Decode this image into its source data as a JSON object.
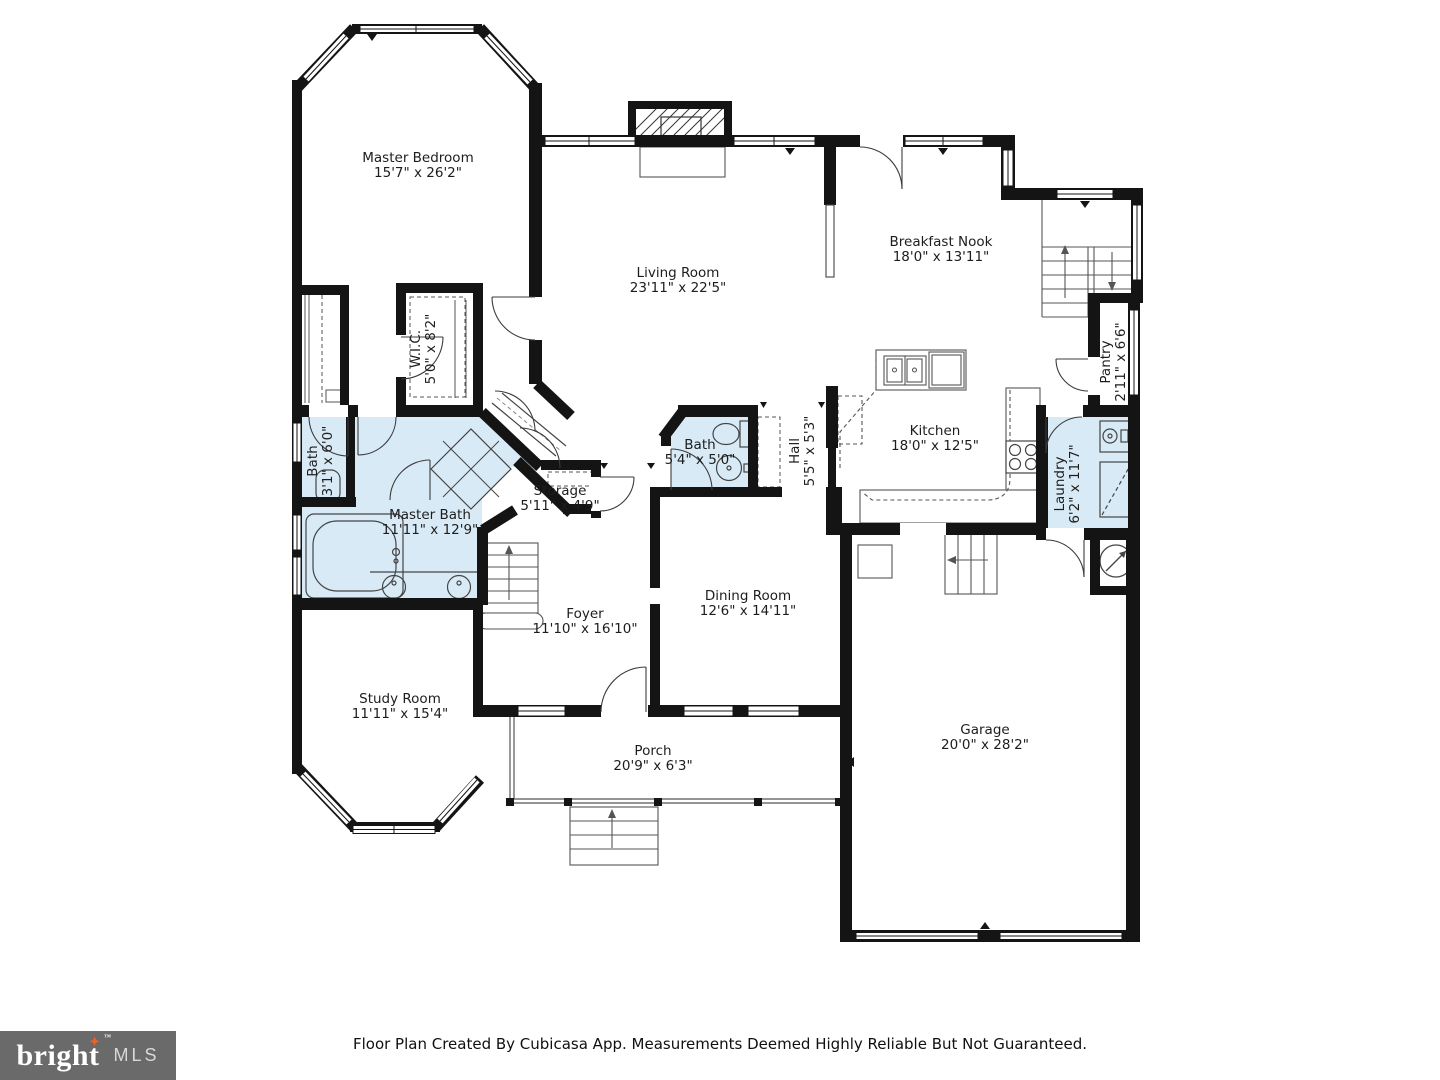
{
  "footer": {
    "logo_main": "bright",
    "logo_sub": "MLS",
    "trademark": "™",
    "disclaimer": "Floor Plan Created By Cubicasa App. Measurements Deemed Highly Reliable But Not Guaranteed."
  },
  "icons": {
    "logo_star": "✦"
  },
  "rooms": [
    {
      "name": "Master Bedroom",
      "dims": "15'7\" x 26'2\""
    },
    {
      "name": "Living Room",
      "dims": "23'11\" x 22'5\""
    },
    {
      "name": "Breakfast Nook",
      "dims": "18'0\" x 13'11\""
    },
    {
      "name": "Kitchen",
      "dims": "18'0\" x 12'5\""
    },
    {
      "name": "Pantry",
      "dims": "2'11\" x 6'6\""
    },
    {
      "name": "Laundry",
      "dims": "6'2\" x 11'7\""
    },
    {
      "name": "Hall",
      "dims": "5'5\" x 5'3\""
    },
    {
      "name": "Bath",
      "dims": "5'4\" x 5'0\""
    },
    {
      "name": "Dining Room",
      "dims": "12'6\" x 14'11\""
    },
    {
      "name": "W.I.C.",
      "dims": "5'0\" x 8'2\""
    },
    {
      "name": "Bath",
      "dims": "3'1\" x 6'0\""
    },
    {
      "name": "Master Bath",
      "dims": "11'11\" x 12'9\""
    },
    {
      "name": "Storage",
      "dims": "5'11\" x 4'9\""
    },
    {
      "name": "Foyer",
      "dims": "11'10\" x 16'10\""
    },
    {
      "name": "Study Room",
      "dims": "11'11\" x 15'4\""
    },
    {
      "name": "Porch",
      "dims": "20'9\" x 6'3\""
    },
    {
      "name": "Garage",
      "dims": "20'0\" x 28'2\""
    }
  ]
}
